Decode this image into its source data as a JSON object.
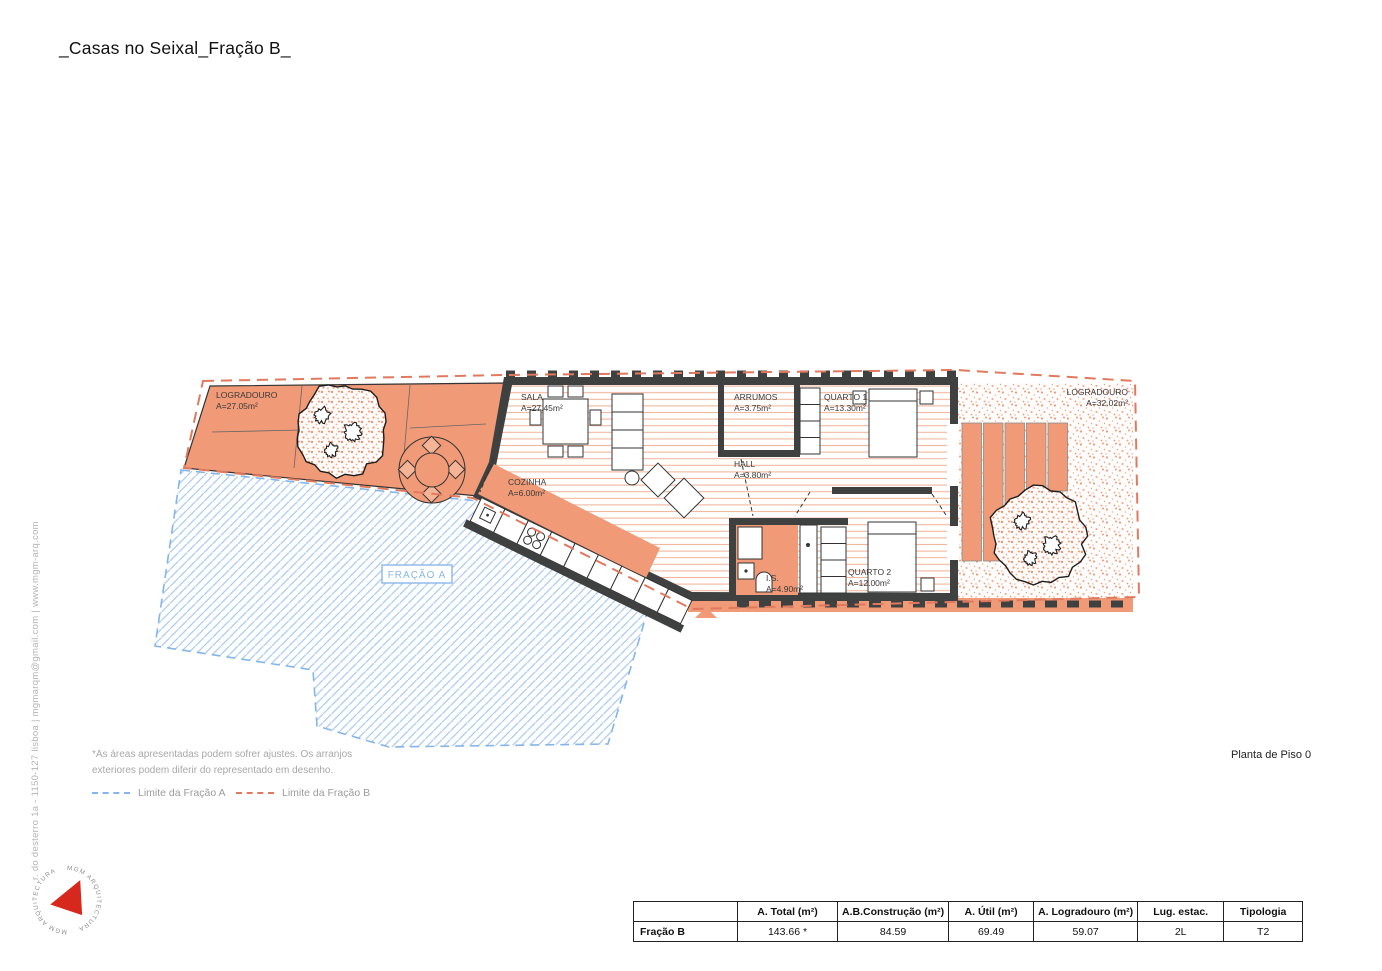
{
  "title": "_Casas no Seixal_Fração B_",
  "drawing_title": "Planta de Piso 0",
  "firm": {
    "address_line": "r. do desterro 1a - 1150-127 lisboa | mgmarqm@gmail.com | www.mgm-arq.com",
    "logo_text": "MGM ARQUITECTURA",
    "logo_color": "#d6281c"
  },
  "plan": {
    "rooms": [
      {
        "name": "LOGRADOURO",
        "area": "A=27.05m²"
      },
      {
        "name": "SALA",
        "area": "A=27.45m²"
      },
      {
        "name": "COZINHA",
        "area": "A=6.00m²"
      },
      {
        "name": "ARRUMOS",
        "area": "A=3.75m²"
      },
      {
        "name": "QUARTO 1",
        "area": "A=13.30m²"
      },
      {
        "name": "HALL",
        "area": "A=3.80m²"
      },
      {
        "name": "I.S.",
        "area": "A=4.90m²"
      },
      {
        "name": "QUARTO 2",
        "area": "A=12.00m²"
      },
      {
        "name": "LOGRADOURO",
        "area": "A=32.02m²"
      }
    ],
    "adjacent_label": "FRAÇÃO A",
    "colors": {
      "fracao_b_fill": "#f09a77",
      "walls": "#3f4040",
      "limit_a": "#85b5ea",
      "limit_b": "#e0795e"
    }
  },
  "notes": {
    "line1": "*As áreas apresentadas podem sofrer ajustes. Os arranjos",
    "line2": "exteriores podem diferir do representado em desenho."
  },
  "legend": {
    "items": [
      {
        "label": "Limite da Fração A",
        "color": "#85b5ea"
      },
      {
        "label": "Limite da Fração B",
        "color": "#e0795e"
      }
    ]
  },
  "table": {
    "headers": [
      "",
      "A. Total (m²)",
      "A.B.Construção (m²)",
      "A. Útil (m²)",
      "A. Logradouro (m²)",
      "Lug. estac.",
      "Tipologia"
    ],
    "rows": [
      {
        "label": "Fração B",
        "values": [
          "143.66 *",
          "84.59",
          "69.49",
          "59.07",
          "2L",
          "T2"
        ]
      }
    ]
  }
}
